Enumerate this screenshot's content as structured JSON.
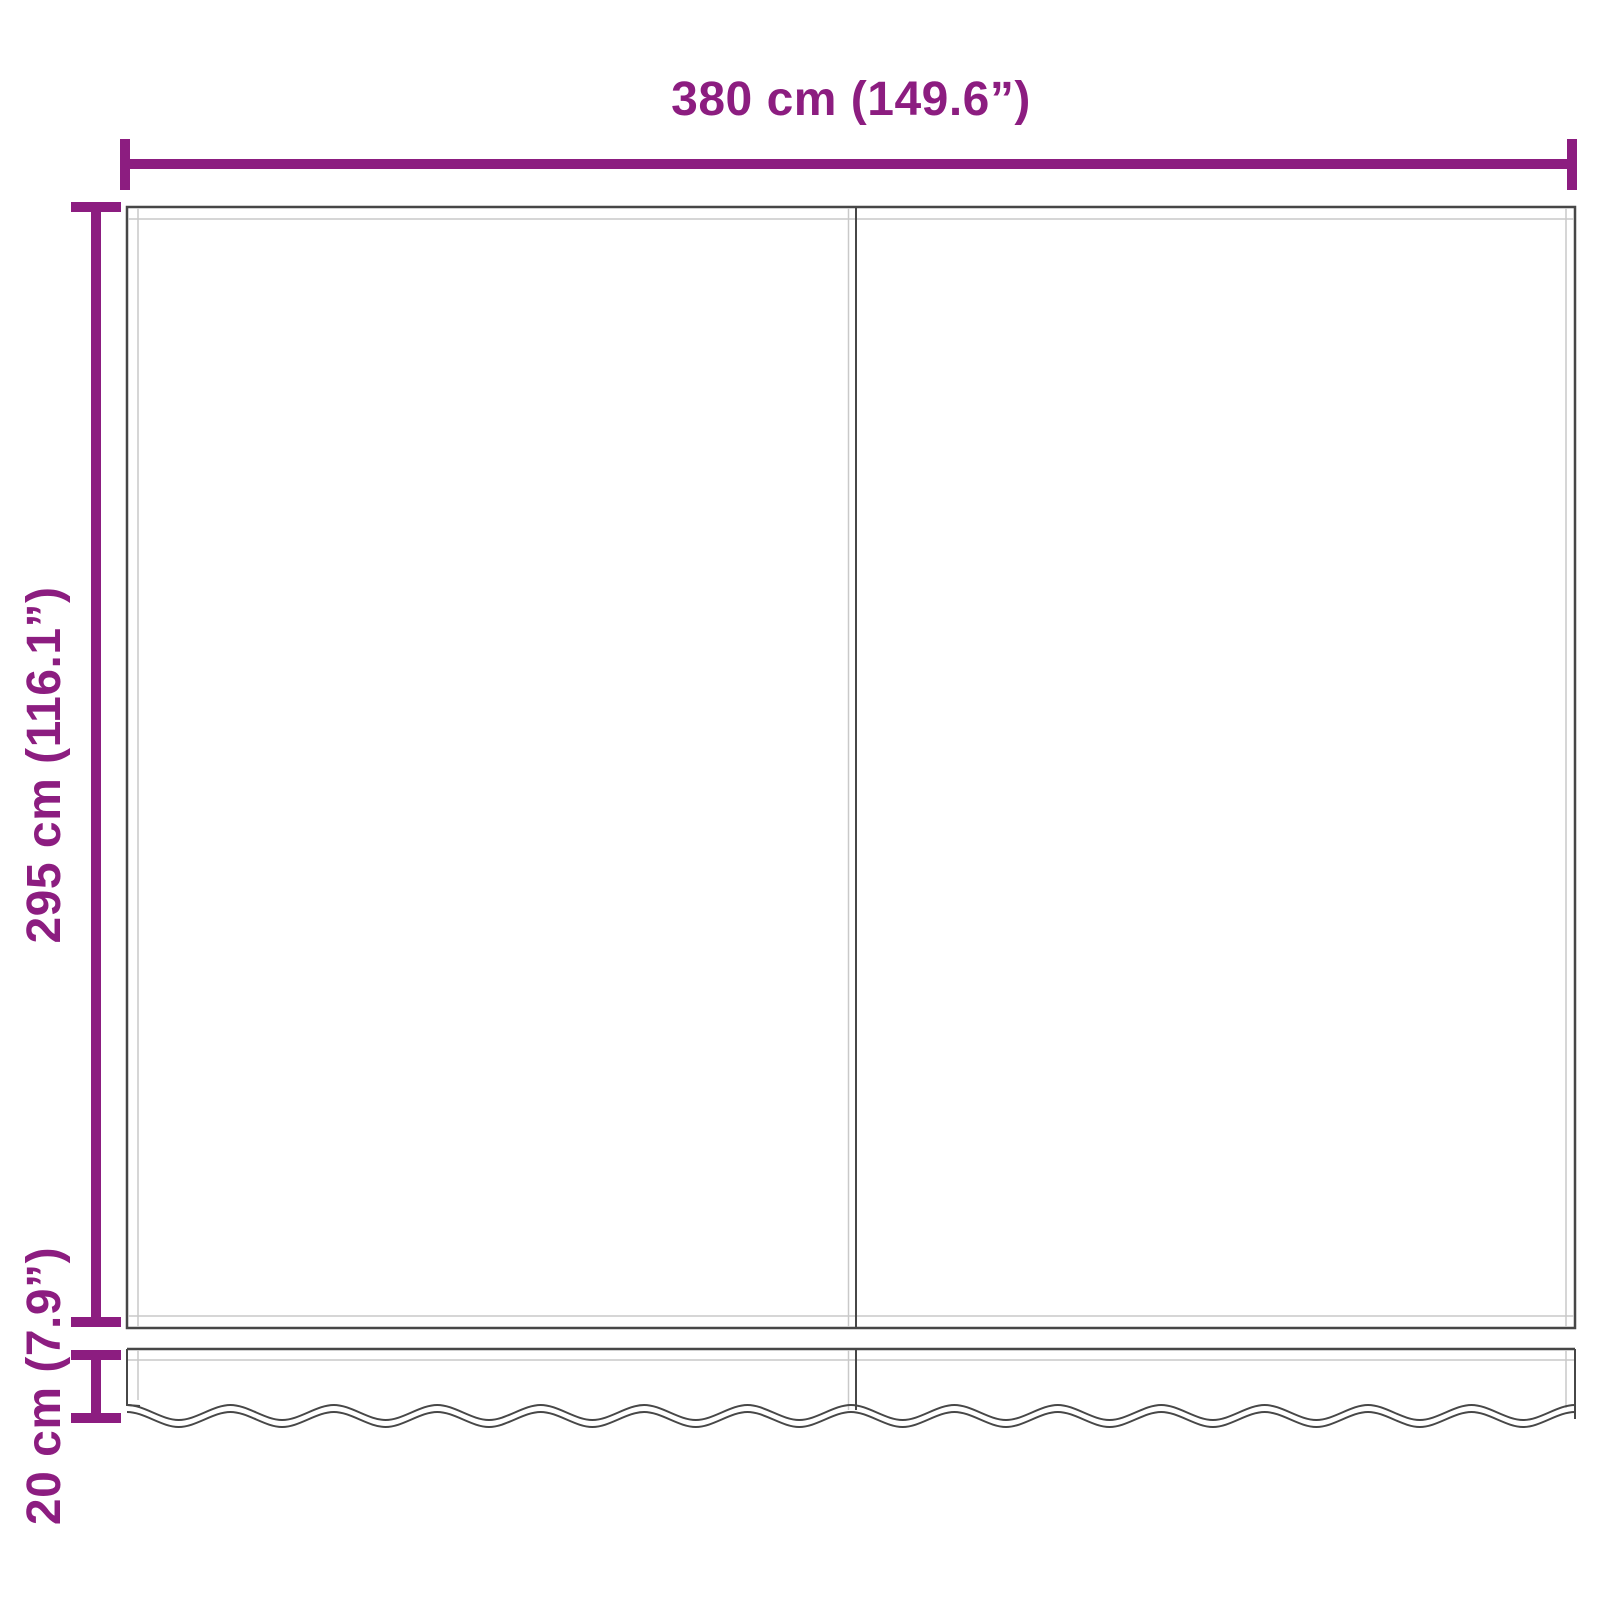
{
  "diagram": {
    "type": "product-dimension-diagram",
    "subject": "awning-replacement-fabric-with-valance",
    "dimensions": {
      "width": {
        "label": "380 cm (149.6”)"
      },
      "height": {
        "label": "295 cm (116.1”)"
      },
      "valance": {
        "label": "20 cm (7.9”)"
      }
    },
    "colors": {
      "dimension": "#8C1D80",
      "outline_dark": "#474747",
      "outline_light": "#c9c9c9",
      "background": "#ffffff"
    }
  }
}
